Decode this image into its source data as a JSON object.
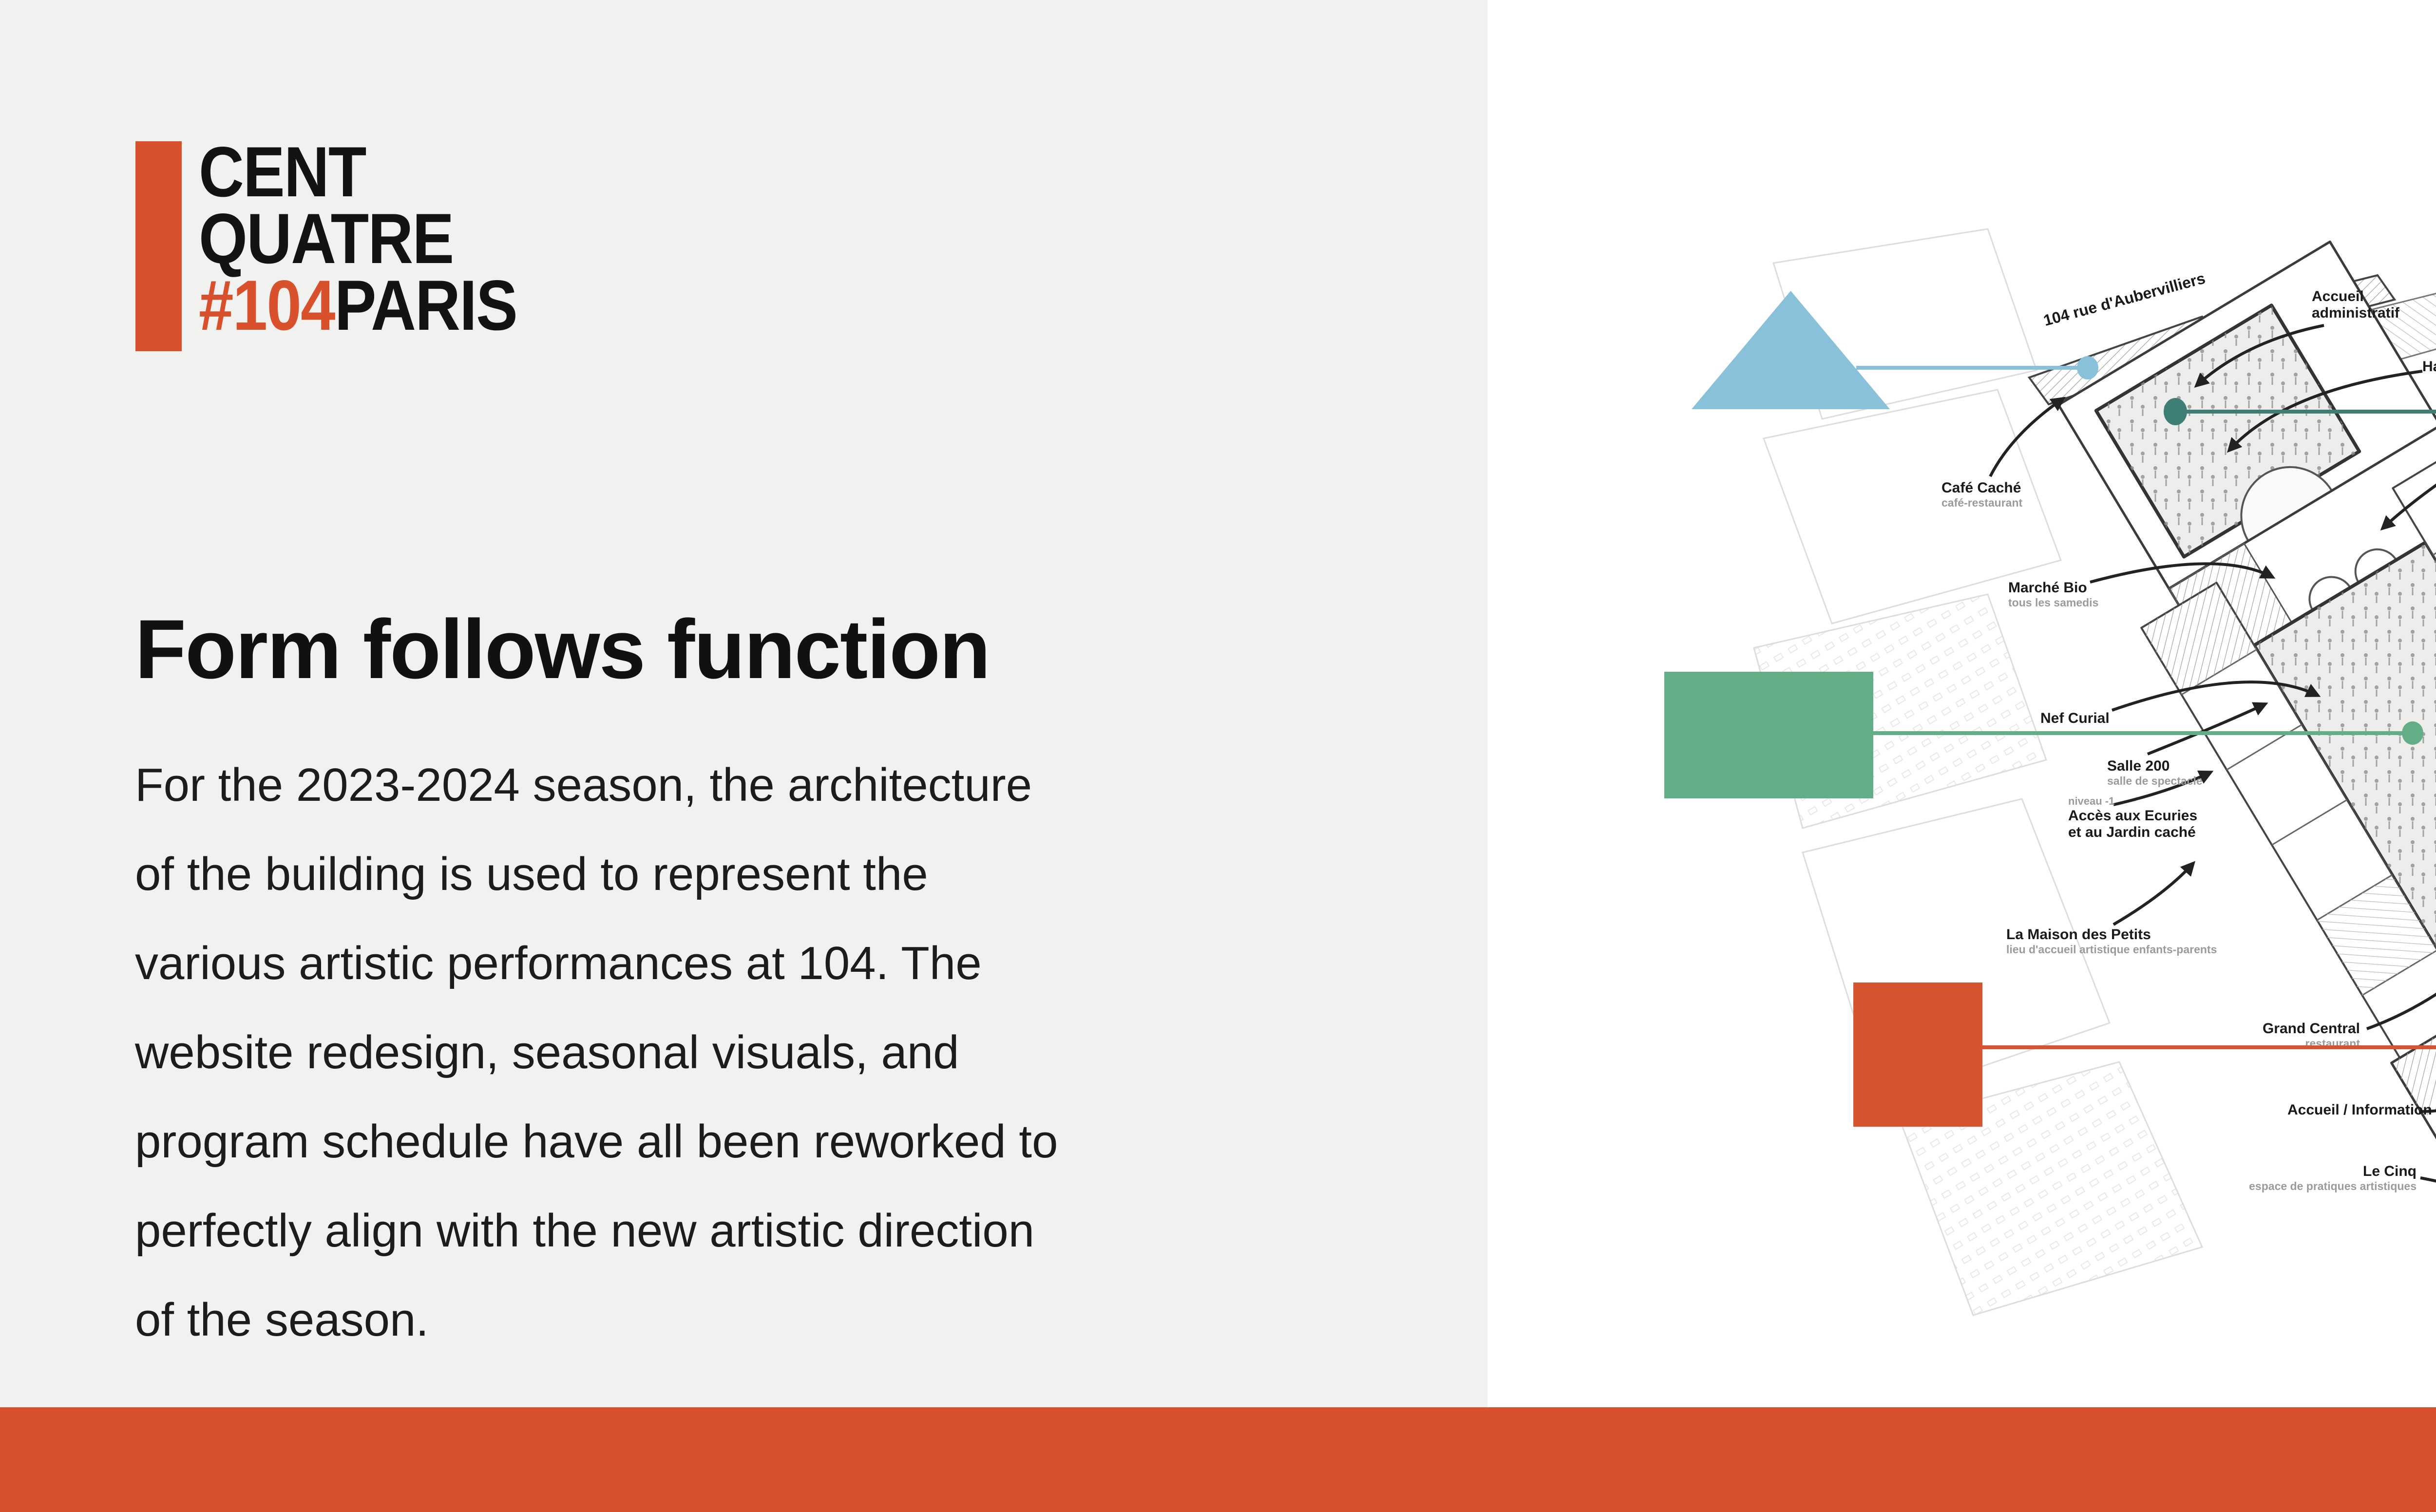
{
  "logo": {
    "line1": "CENT",
    "line2": "QUATRE",
    "hash": "#104",
    "city": "PARIS"
  },
  "content": {
    "heading": "Form follows function",
    "paragraph": "For the 2023-2024 season, the architecture\nof the building is used to represent the\nvarious artistic performances at 104. The\nwebsite redesign, seasonal visuals, and\nprogram schedule have all been reworked to\nperfectly align with the new artistic direction\nof the season."
  },
  "map": {
    "streets": {
      "top": "104 rue d'Aubervilliers",
      "bottom": "5 rue Curial"
    },
    "labels": [
      {
        "title": "Accueil\nadministratif"
      },
      {
        "title": "Halle Aubervilliers"
      },
      {
        "title": "Camion à pizzas"
      },
      {
        "title": "Café Caché",
        "sub": "café-restaurant"
      },
      {
        "title": "Marché Bio",
        "sub": "tous les samedis"
      },
      {
        "title": "Salle 400",
        "sub": "salle de spectacle"
      },
      {
        "title": "Nef Curial"
      },
      {
        "title": "Salle 200",
        "sub": "salle de spectacle"
      },
      {
        "pre": "niveau -1",
        "title": "Accès aux Ecuries\net au Jardin caché"
      },
      {
        "title": "La Maison des Petits",
        "sub": "lieu d'accueil artistique enfants-parents"
      },
      {
        "title": "Grand Central",
        "sub": "restaurant"
      },
      {
        "title": "Accueil / Information"
      },
      {
        "title": "Le Cinq",
        "sub": "espace de pratiques artistiques"
      },
      {
        "title": "Galerie éphémère"
      },
      {
        "title": "Emmaüs Défi"
      },
      {
        "pre": "niveau -1",
        "title": "Jardin caché",
        "sub": "humer, planter, arroser !"
      },
      {
        "title": "Land",
        "sub": "fleuriste"
      }
    ],
    "corners": {
      "title": "104corners :",
      "items": [
        {
          "title": "-Billetterie",
          "sub": "du CENTQUATRE-PARIS"
        },
        {
          "title": "-L'Arabesque",
          "sub": "librairie"
        },
        {
          "title": "-Kiblind",
          "sub": "édition arts graphiques"
        },
        {
          "title": "-L'effet PAP'",
          "sub": "objets et cadeaux écoresponsables"
        }
      ]
    },
    "factory": {
      "title": "104factory",
      "sub": "l'incubateur des startups culturelles et créatives"
    }
  },
  "colors": {
    "accent_orange": "#d8512c",
    "panel_gray": "#f1f1ef",
    "shape_light_blue": "#8ac1da",
    "shape_teal": "#3f7e76",
    "shape_blue": "#1512d8",
    "shape_green": "#63ae87",
    "shape_orange": "#d4552f",
    "shape_pink": "#d06476"
  }
}
